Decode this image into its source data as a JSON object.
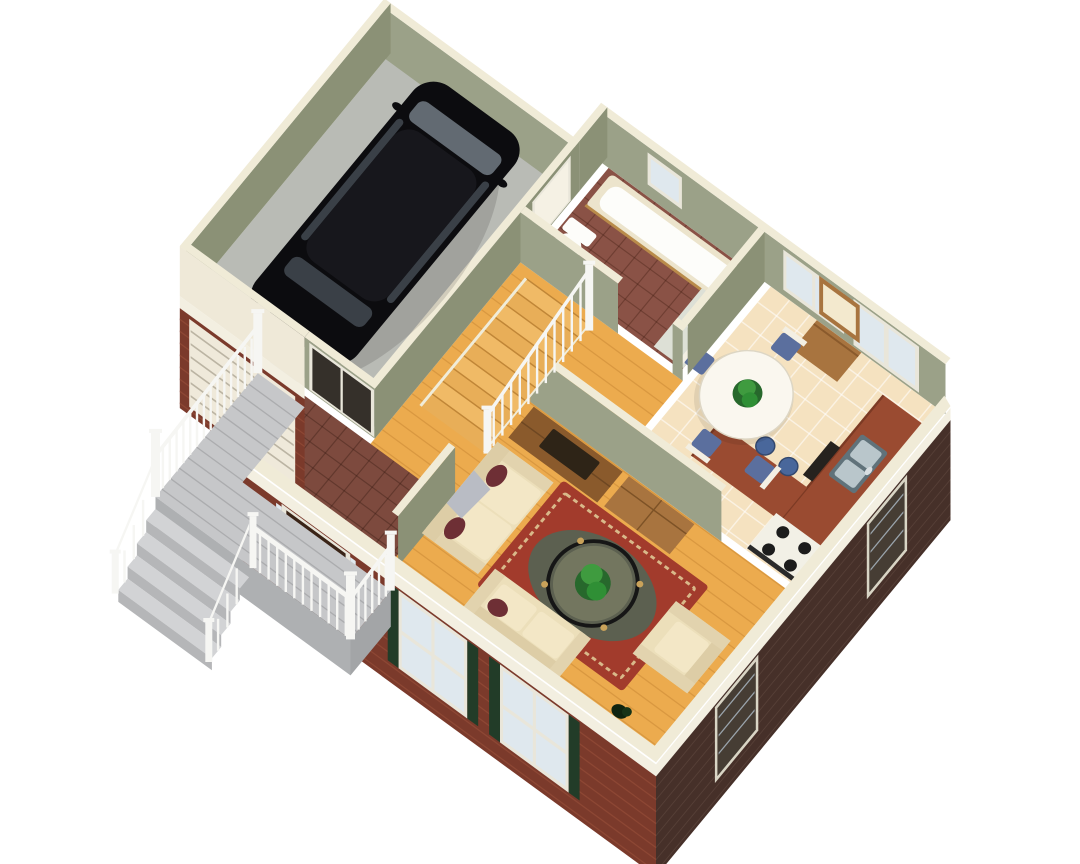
{
  "scene": {
    "description": "3D isometric cutaway rendering of a house first-floor plan, viewed from above at an angle, on a white background. No text labels are rendered in the image.",
    "view": "axonometric-cutaway",
    "rooms": [
      {
        "name": "garage",
        "floor": "concrete-gray",
        "contents": [
          "black-suv",
          "garage-door"
        ]
      },
      {
        "name": "bathroom",
        "floor": "brick-red-tile",
        "contents": [
          "bathtub",
          "vanity-sink",
          "toilet",
          "window"
        ]
      },
      {
        "name": "dining-room",
        "floor": "cream-tile",
        "contents": [
          "round-table",
          "centerpiece-plant",
          "four-chairs",
          "window",
          "patio-door"
        ]
      },
      {
        "name": "kitchen",
        "floor": "cream-tile",
        "contents": [
          "l-shaped-counter",
          "double-sink",
          "stove",
          "dishwasher",
          "peninsula",
          "three-stools",
          "desk-with-mirror",
          "window"
        ]
      },
      {
        "name": "living-room",
        "floor": "hardwood",
        "contents": [
          "sofa",
          "loveseat",
          "armchair",
          "oriental-rug",
          "round-glass-coffee-table",
          "potted-plant",
          "tv-cabinet",
          "hutch",
          "front-windows-with-shutters"
        ]
      },
      {
        "name": "foyer",
        "floor": "brick-red-tile",
        "contents": [
          "front-door",
          "sidelights",
          "closet-sliding-doors"
        ]
      },
      {
        "name": "staircase",
        "contents": [
          "wood-treads",
          "white-railing"
        ]
      },
      {
        "name": "front-porch",
        "contents": [
          "gray-deck",
          "white-railings",
          "steps",
          "posts"
        ]
      }
    ]
  },
  "colors": {
    "bg": "#ffffff",
    "wallTop": "#f0ebd7",
    "sage": "#9ba188",
    "sageD": "#8b9176",
    "extFace": "#efe9d8",
    "garageFloor": "#b9bbb5",
    "wood": "#ecab4e",
    "tileCream": "#f5e2c0",
    "tileMaroon": "#8a5246",
    "tileMaroon2": "#7d4a3e",
    "deckGray": "#c6c7c9",
    "deckEdge": "#aeb0b2",
    "deckEdge2": "#a3a5a7",
    "stepLight": "#d2d3d5",
    "stepFace": "#b5b6b8",
    "rail": "#f6f6f3",
    "carBody": "#0c0c0f",
    "carRoof": "#17171c",
    "glass": "#626a72",
    "glassD": "#3a4047",
    "porcelain": "#fdfdfa",
    "tubRim": "#ece4cc",
    "tubWood": "#b98b4a",
    "vanity": "#dde0d6",
    "counter": "#9a4b31",
    "counterEdge": "#7c3a24",
    "steel": "#b9c6cb",
    "steelD": "#60727a",
    "stove": "#f2f0e6",
    "black": "#26221e",
    "woodFurn": "#a8743f",
    "woodFurnD": "#8a5a2c",
    "tv": "#2e2417",
    "sofa": "#ecdfba",
    "cushion": "#f3e7c6",
    "pillow": "#6e2f35",
    "throw": "#b9bcc4",
    "rugRed": "#a23b2c",
    "rugBorder": "#d9b98a",
    "rugField": "#5c6050",
    "glassDisc": "#73765f",
    "plant": "#3f9b3f",
    "plantD": "#27682c",
    "chair": "#f3efe3",
    "seatBlue": "#5b6f9e",
    "stool": "#49679b",
    "brick": "#7b3a2b",
    "brickLt": "#8d4734",
    "brickDark": "#463029",
    "brickDkLt": "#574038",
    "band": "#f3efe1",
    "frame": "#e9e6da",
    "pane": "#dfe8ee",
    "paneDk": "#463d34",
    "door": "#3a2417",
    "shutter": "#223c28",
    "closetDark": "#35302a",
    "stairA": "#e8ae58",
    "stairB": "#f0ba66"
  }
}
